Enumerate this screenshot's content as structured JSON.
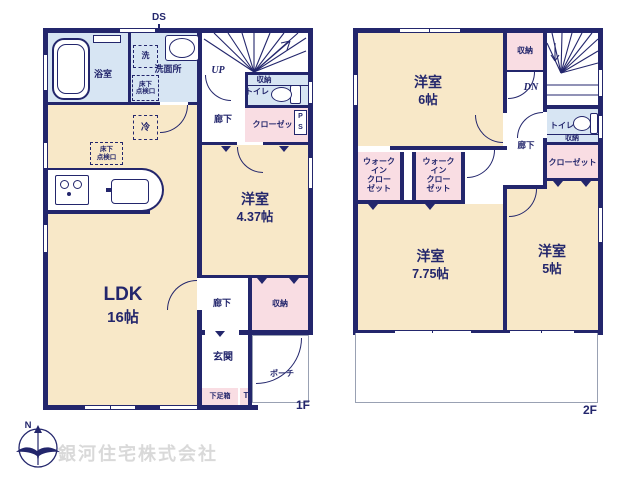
{
  "floor1": {
    "floor_label": "1F",
    "ds": "DS",
    "bathroom": "浴室",
    "washroom": "洗面所",
    "washer": "洗",
    "underfloor_hatch_lines": [
      "床下",
      "点検口"
    ],
    "fridge": "冷",
    "up": "UP",
    "toilet_storage": "収納",
    "toilet": "トイレ",
    "hallway_upper": "廊下",
    "closet": "クローゼット",
    "ps_lines": [
      "P",
      "S"
    ],
    "western_room_name": "洋室",
    "western_room_size": "4.37帖",
    "ldk_name": "LDK",
    "ldk_size": "16帖",
    "hallway_lower": "廊下",
    "hall_storage": "収納",
    "entrance": "玄関",
    "porch": "ポーチ",
    "shoe_box": "下足箱",
    "t": "T"
  },
  "floor2": {
    "floor_label": "2F",
    "room6_name": "洋室",
    "room6_size": "6帖",
    "storage": "収納",
    "dn": "DN",
    "toilet": "トイレ",
    "toilet_storage": "収納",
    "hallway": "廊下",
    "closet": "クローゼット",
    "wic_lines": [
      "ウォーク",
      "イン",
      "クロー",
      "ゼット"
    ],
    "room775_name": "洋室",
    "room775_size": "7.75帖",
    "room5_name": "洋室",
    "room5_size": "5帖"
  },
  "footer": {
    "company": "銀河住宅株式会社",
    "compass_north": "N"
  },
  "colors": {
    "wall": "#23266c",
    "room_tan": "#f8e8c8",
    "room_blue": "#d7e5f3",
    "room_pink": "#f9dde3"
  }
}
